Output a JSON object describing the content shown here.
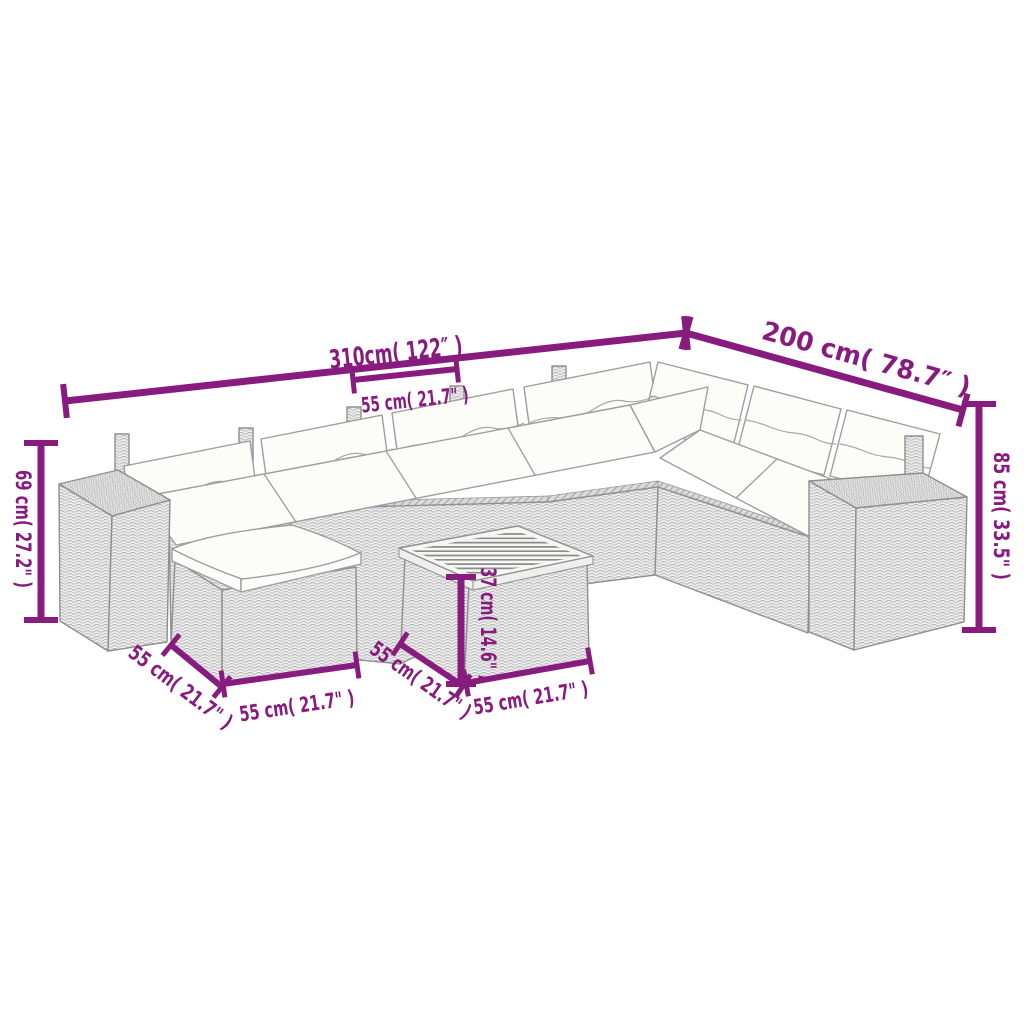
{
  "figure": {
    "kind": "furniture-dimension-diagram",
    "background": "#ffffff",
    "accent": "#881C7E",
    "line_gray": "#8f8f8f"
  },
  "dimensions": [
    {
      "name": "sofa-total-width",
      "label": "310cm( 122″ )",
      "line": {
        "x1": 65,
        "y1": 401,
        "x2": 686,
        "y2": 333
      },
      "stroke_w": 7,
      "tick_len": 34,
      "label_pos": {
        "x": 396,
        "y": 354,
        "rotate": -6.2,
        "size": 26,
        "tlen": 134
      }
    },
    {
      "name": "seat-module-width",
      "label": "55 cm( 21.7\" )",
      "line": {
        "x1": 353,
        "y1": 380,
        "x2": 457,
        "y2": 369
      },
      "stroke_w": 6,
      "tick_len": 27,
      "label_pos": {
        "x": 415,
        "y": 401,
        "rotate": -6,
        "size": 21,
        "tlen": 108
      }
    },
    {
      "name": "sofa-total-depth",
      "label": "200 cm( 78.7″ )",
      "line": {
        "x1": 686,
        "y1": 333,
        "x2": 963,
        "y2": 410
      },
      "stroke_w": 7,
      "tick_len": 34,
      "label_pos": {
        "x": 866,
        "y": 360,
        "rotate": 15.5,
        "size": 26,
        "tlen": 215
      }
    },
    {
      "name": "backrest-height",
      "label": "85 cm( 33.5\" )",
      "line": {
        "x1": 979,
        "y1": 404,
        "x2": 979,
        "y2": 630
      },
      "stroke_w": 7,
      "tick_len": 34,
      "label_pos": {
        "x": 1000,
        "y": 516,
        "rotate": 90,
        "size": 21,
        "tlen": 128
      }
    },
    {
      "name": "armrest-height",
      "label": "69 cm( 27.2\" )",
      "line": {
        "x1": 41,
        "y1": 443,
        "x2": 41,
        "y2": 620
      },
      "stroke_w": 7,
      "tick_len": 34,
      "label_pos": {
        "x": 22,
        "y": 529,
        "rotate": 90,
        "size": 21,
        "tlen": 118
      }
    },
    {
      "name": "table-height",
      "label": "37 cm( 14.6\" )",
      "line": {
        "x1": 461,
        "y1": 577,
        "x2": 461,
        "y2": 684
      },
      "stroke_w": 7,
      "tick_len": 30,
      "label_pos": {
        "x": 487,
        "y": 624,
        "rotate": 90,
        "size": 21,
        "tlen": 113
      }
    },
    {
      "name": "ottoman-depth",
      "label": "55 cm( 21.7\" )",
      "line": {
        "x1": 171,
        "y1": 645,
        "x2": 222,
        "y2": 687
      },
      "stroke_w": 6,
      "tick_len": 27,
      "label_pos": {
        "x": 180,
        "y": 688,
        "rotate": 37,
        "size": 21,
        "tlen": 124
      }
    },
    {
      "name": "ottoman-width",
      "label": "55 cm( 21.7\" )",
      "line": {
        "x1": 223,
        "y1": 684,
        "x2": 357,
        "y2": 665
      },
      "stroke_w": 6,
      "tick_len": 27,
      "label_pos": {
        "x": 297,
        "y": 707,
        "rotate": -8.5,
        "size": 21,
        "tlen": 116
      }
    },
    {
      "name": "table-depth",
      "label": "55 cm( 21.7\" )",
      "line": {
        "x1": 400,
        "y1": 644,
        "x2": 463,
        "y2": 686
      },
      "stroke_w": 6,
      "tick_len": 27,
      "label_pos": {
        "x": 420,
        "y": 681,
        "rotate": 35,
        "size": 21,
        "tlen": 118
      }
    },
    {
      "name": "table-width",
      "label": "55 cm( 21.7\" )",
      "line": {
        "x1": 466,
        "y1": 683,
        "x2": 590,
        "y2": 661
      },
      "stroke_w": 6,
      "tick_len": 27,
      "label_pos": {
        "x": 531,
        "y": 699,
        "rotate": -9.5,
        "size": 21,
        "tlen": 116
      }
    }
  ]
}
